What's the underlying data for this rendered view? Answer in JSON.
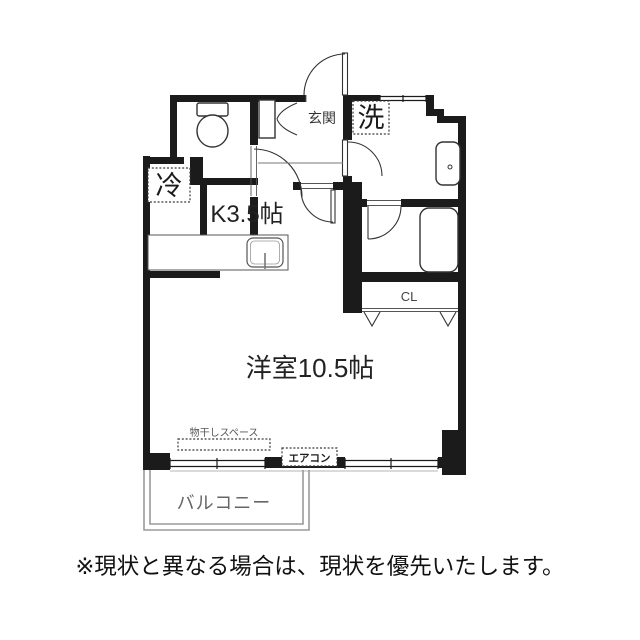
{
  "floor_plan": {
    "rooms": {
      "entrance_label": "玄関",
      "kitchen_label": "K3.5帖",
      "main_room_label": "洋室10.5帖",
      "closet_label": "CL",
      "balcony_label": "バルコニー"
    },
    "equipment": {
      "washer_label": "洗",
      "fridge_label": "冷",
      "aircon_label": "エアコン",
      "drying_space_label": "物干しスペース"
    },
    "colors": {
      "wall": "#1b1b1b",
      "line": "#333333",
      "balcony_line": "#9a9a9a"
    }
  },
  "footer": {
    "disclaimer": "※現状と異なる場合は、現状を優先いたします。"
  }
}
